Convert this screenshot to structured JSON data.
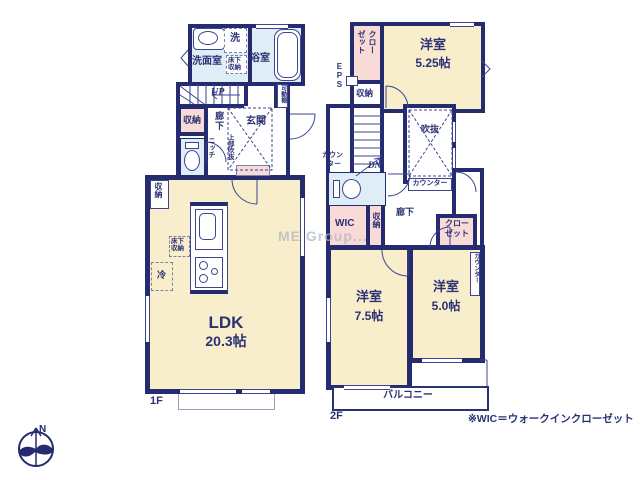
{
  "watermark": "ME Group...",
  "note": "※WIC＝ウォークインクローゼット",
  "colors": {
    "wall_navy": "#252b6f",
    "room_cream": "#f9eecb",
    "closet_pink": "#f8dad6",
    "wet_area_blue": "#dfeef6",
    "label_navy": "#2b3274"
  },
  "compass": {
    "north": "N"
  },
  "floor1": {
    "label": "1F",
    "washroom": {
      "name": "洗面室",
      "washer": "洗",
      "underfloor": "床下収納"
    },
    "bathroom": {
      "name": "浴室"
    },
    "hall": {
      "up": "UP",
      "shelf": "可動棚",
      "storage": "収納",
      "corridor": "廊下",
      "niche": "ニッチ",
      "entrance": "玄関",
      "void_above": "上部吹抜"
    },
    "ldk": {
      "name": "LDK",
      "size": "20.3帖",
      "storage": "収納",
      "underfloor": "床下収納",
      "fridge": "冷"
    }
  },
  "floor2": {
    "label": "2F",
    "eps": "EPS",
    "closet_nw": {
      "line1": "クロー",
      "line2": "ゼット"
    },
    "storage_n": "収納",
    "room_525": {
      "name": "洋室",
      "size": "5.25帖"
    },
    "stairs": {
      "dn": "DN"
    },
    "void": {
      "name": "吹抜"
    },
    "counter_void": "カウンター",
    "counter_wc": {
      "line1": "カウン",
      "line2": "ター"
    },
    "wic": "WIC",
    "storage_mid": "収納",
    "corridor": "廊下",
    "closet_mid": {
      "line1": "クロー",
      "line2": "ゼット"
    },
    "room_75": {
      "name": "洋室",
      "size": "7.5帖"
    },
    "room_50": {
      "name": "洋室",
      "size": "5.0帖"
    },
    "counter_e": "カウンター",
    "balcony": "バルコニー"
  }
}
